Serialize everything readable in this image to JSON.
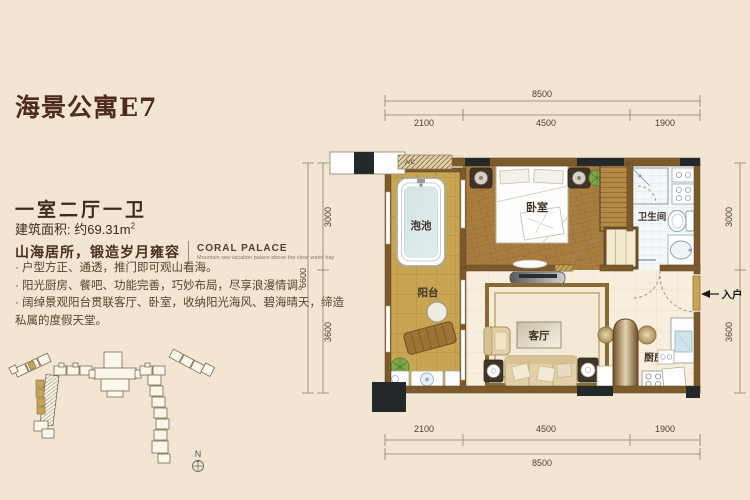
{
  "page": {
    "title": "海景公寓E7",
    "layout_type": "一室二厅一卫",
    "area_label": "建筑面积: ",
    "area_value": "约69.31m",
    "area_sup": "2",
    "slogan_cn": "山海居所，锻造岁月雍容",
    "brand_en": "CORAL PALACE",
    "brand_sub": "Mountain sea vacation palace above the clear water bay",
    "bullets": [
      "户型方正、通透，推门即可观山看海。",
      "阳光厨房、餐吧、功能完善，巧妙布局，尽享浪漫情调。",
      "阔绰景观阳台贯联客厅、卧室，收纳阳光海风、碧海晴天，缔造私属的度假天堂。"
    ]
  },
  "plan": {
    "rooms": {
      "pool": "泡池",
      "balcony": "阳台",
      "bedroom": "卧室",
      "bathroom": "卫生间",
      "living": "客厅",
      "kitchen": "厨房",
      "entry": "入户",
      "ac": "A/C"
    },
    "dims": {
      "top_total": "8500",
      "top_segments": [
        "2100",
        "4500",
        "1900"
      ],
      "bottom_total": "8500",
      "bottom_segments": [
        "2100",
        "4500",
        "1900"
      ],
      "left_total": "6600",
      "left_segments": [
        "3000",
        "3600"
      ],
      "right_segments": [
        "3000",
        "3600"
      ]
    }
  },
  "siteplan": {
    "north_label": "N"
  },
  "colors": {
    "background": "#f2e5d1",
    "title": "#4e2d1c",
    "body_text": "#57432f",
    "wall": "#7d5a2c",
    "column": "#23282a",
    "balcony_floor": "#c8a553",
    "wood_floor": "#a87e40",
    "tile_cream": "#f7eedd",
    "water": "#d9ecf2",
    "highlight_gold": "#c8a553"
  }
}
